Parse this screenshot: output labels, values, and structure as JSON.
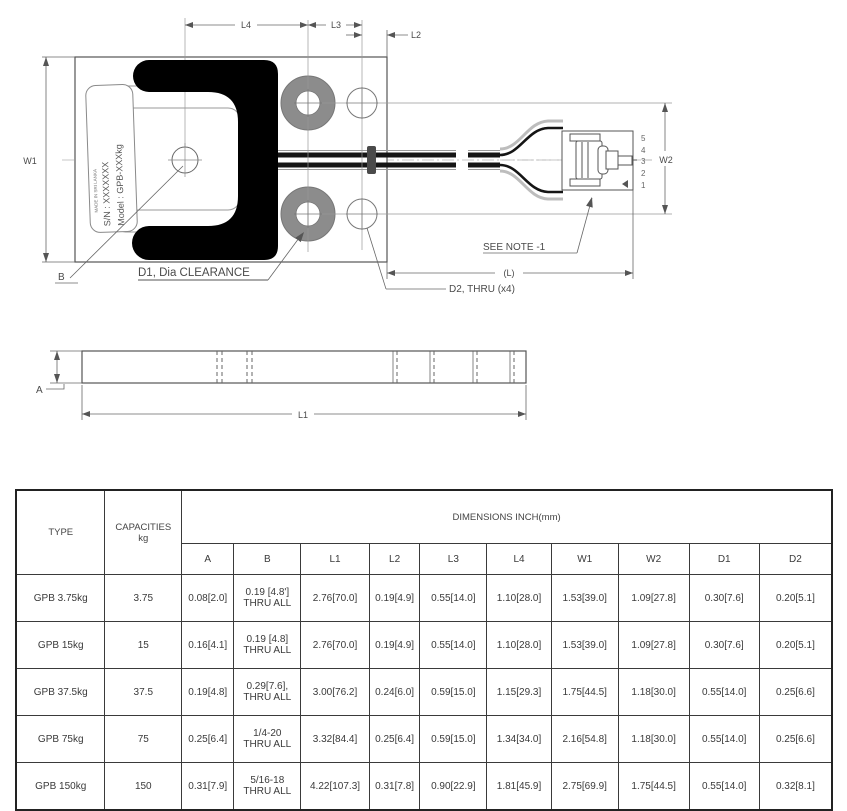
{
  "colors": {
    "line": "#555555",
    "black_fill": "#000000",
    "bushing_gray": "#8c8c8c"
  },
  "drawing": {
    "nameplate": {
      "model": "Model : GPB-XXXkg",
      "serial": "S/N : XXXXXXX",
      "origin": "MADE IN SRI LANKA"
    },
    "dims": {
      "w1": "W1",
      "w2": "W2",
      "l1": "L1",
      "l2": "L2",
      "l3": "L3",
      "l4": "L4",
      "l": "(L)",
      "a": "A",
      "b": "B"
    },
    "callouts": {
      "d1": "D1, Dia CLEARANCE",
      "d2": "D2, THRU (x4)",
      "see_note": "SEE NOTE -1"
    },
    "connector_pins": [
      "5",
      "4",
      "3",
      "2",
      "1"
    ]
  },
  "table": {
    "headers": {
      "type": "TYPE",
      "capacities": "CAPACITIES\nkg",
      "dimensions": "DIMENSIONS INCH(mm)",
      "columns": [
        "A",
        "B",
        "L1",
        "L2",
        "L3",
        "L4",
        "W1",
        "W2",
        "D1",
        "D2"
      ]
    },
    "rows": [
      {
        "type": "GPB 3.75kg",
        "capacity": "3.75",
        "values": [
          "0.08[2.0]",
          "0.19 [4.8']\nTHRU ALL",
          "2.76[70.0]",
          "0.19[4.9]",
          "0.55[14.0]",
          "1.10[28.0]",
          "1.53[39.0]",
          "1.09[27.8]",
          "0.30[7.6]",
          "0.20[5.1]"
        ]
      },
      {
        "type": "GPB 15kg",
        "capacity": "15",
        "values": [
          "0.16[4.1]",
          "0.19 [4.8]\nTHRU ALL",
          "2.76[70.0]",
          "0.19[4.9]",
          "0.55[14.0]",
          "1.10[28.0]",
          "1.53[39.0]",
          "1.09[27.8]",
          "0.30[7.6]",
          "0.20[5.1]"
        ]
      },
      {
        "type": "GPB 37.5kg",
        "capacity": "37.5",
        "values": [
          "0.19[4.8]",
          "0.29[7.6],\nTHRU ALL",
          "3.00[76.2]",
          "0.24[6.0]",
          "0.59[15.0]",
          "1.15[29.3]",
          "1.75[44.5]",
          "1.18[30.0]",
          "0.55[14.0]",
          "0.25[6.6]"
        ]
      },
      {
        "type": "GPB 75kg",
        "capacity": "75",
        "values": [
          "0.25[6.4]",
          "1/4-20\nTHRU ALL",
          "3.32[84.4]",
          "0.25[6.4]",
          "0.59[15.0]",
          "1.34[34.0]",
          "2.16[54.8]",
          "1.18[30.0]",
          "0.55[14.0]",
          "0.25[6.6]"
        ]
      },
      {
        "type": "GPB 150kg",
        "capacity": "150",
        "values": [
          "0.31[7.9]",
          "5/16-18\nTHRU ALL",
          "4.22[107.3]",
          "0.31[7.8]",
          "0.90[22.9]",
          "1.81[45.9]",
          "2.75[69.9]",
          "1.75[44.5]",
          "0.55[14.0]",
          "0.32[8.1]"
        ]
      }
    ]
  }
}
